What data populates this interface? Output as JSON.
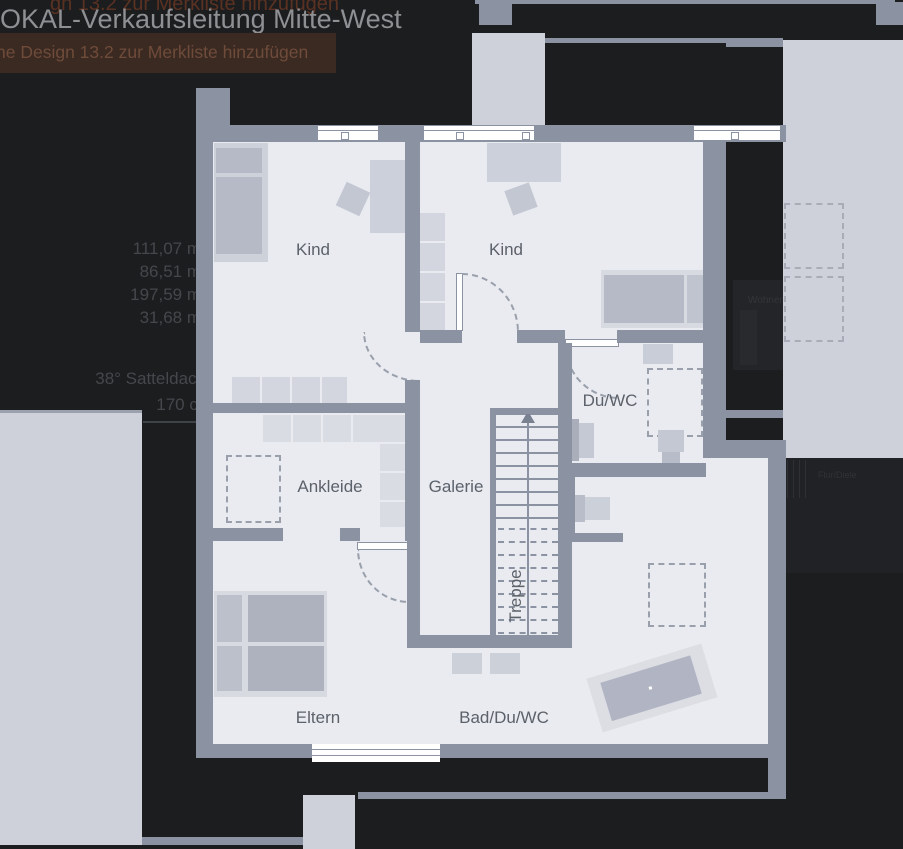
{
  "header": {
    "title": "OKAL-Verkaufsleitung Mitte-West",
    "tooltip_faded": "gn 13.2 zur Merkliste hinzufügen",
    "tooltip": "ne Design 13.2 zur Merkliste hinzufügen"
  },
  "left_panel": {
    "areas": [
      "111,07 m",
      "86,51 m",
      "197,59 m",
      "31,68 m"
    ],
    "roof": "38° Satteldach",
    "knee_height": "170 cm"
  },
  "floorplan": {
    "rooms": {
      "kind1": "Kind",
      "kind2": "Kind",
      "du_wc": "Du/WC",
      "ankleide": "Ankleide",
      "galerie": "Galerie",
      "treppe": "Treppe",
      "eltern": "Eltern",
      "bad_du_wc": "Bad/Du/WC"
    }
  },
  "underlying_page": {
    "heading_fragment": "oss",
    "room_fragment_wohnen": "Wohnen",
    "room_fragment_flur": "Flur/Diele"
  },
  "colors": {
    "background": "#1c1d1f",
    "wall": "#8b93a2",
    "floor": "#e9ebf1",
    "underlay_light": "#ced1d9",
    "tooltip_bg": "#3a2a21",
    "accent_orange": "#7c451f"
  }
}
